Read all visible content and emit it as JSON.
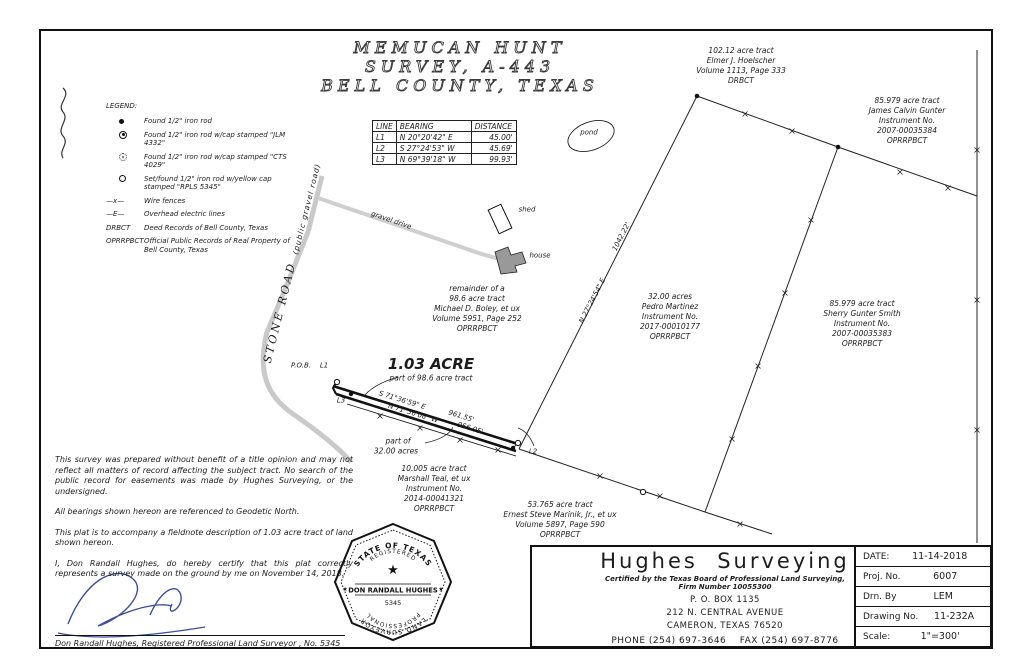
{
  "colors": {
    "ink": "#1c1c1c",
    "road_gray": "#c9c9c9",
    "house_fill": "#999999",
    "signature_blue": "#3c4f9e"
  },
  "title": {
    "line1": "MEMUCAN HUNT",
    "line2": "SURVEY, A-443",
    "line3": "BELL COUNTY, TEXAS"
  },
  "legend": {
    "heading": "LEGEND:",
    "items": [
      {
        "symbol": "found-iron-rod-dot",
        "text": "Found 1/2\" iron rod"
      },
      {
        "symbol": "found-iron-rod-cap-jlm",
        "text": "Found 1/2\" iron rod w/cap stamped \"JLM 4332\""
      },
      {
        "symbol": "found-iron-rod-cap-cts",
        "text": "Found 1/2\" iron rod w/cap stamped \"CTS 4029\""
      },
      {
        "symbol": "set-iron-rod-yellow-cap",
        "text": "Set/found 1/2\" iron rod w/yellow cap stamped \"RPLS 5345\""
      },
      {
        "symbol": "—x—",
        "text": "Wire fences"
      },
      {
        "symbol": "—E—",
        "text": "Overhead electric lines"
      },
      {
        "symbol": "DRBCT",
        "text": "Deed Records of Bell County, Texas"
      },
      {
        "symbol": "OPRRPBCT",
        "text": "Official Public Records of Real Property of Bell County, Texas"
      }
    ]
  },
  "line_table": {
    "headers": [
      "LINE",
      "BEARING",
      "DISTANCE"
    ],
    "rows": [
      [
        "L1",
        "N 20°20'42\" E",
        "45.00'"
      ],
      [
        "L2",
        "S 27°24'53\" W",
        "45.69'"
      ],
      [
        "L3",
        "N 69°39'18\" W",
        "99.93'"
      ]
    ]
  },
  "tracts": {
    "hoelscher": {
      "lines": [
        "102.12 acre tract",
        "Elmer J. Hoelscher",
        "Volume 1113, Page 333",
        "DRBCT"
      ]
    },
    "gunter_james": {
      "lines": [
        "85.979 acre tract",
        "James Calvin Gunter",
        "Instrument No.",
        "2007-00035384",
        "OPRRPBCT"
      ]
    },
    "boley": {
      "lines": [
        "remainder of a",
        "98.6 acre tract",
        "Michael D. Boley, et ux",
        "Volume 5951, Page 252",
        "OPRRPBCT"
      ]
    },
    "martinez": {
      "lines": [
        "32.00 acres",
        "Pedro Martinez",
        "Instrument No.",
        "2017-00010177",
        "OPRRPBCT"
      ]
    },
    "gunter_sherry": {
      "lines": [
        "85.979 acre tract",
        "Sherry Gunter Smith",
        "Instrument No.",
        "2007-00035383",
        "OPRRPBCT"
      ]
    },
    "teal": {
      "lines": [
        "10.005 acre tract",
        "Marshall Teal, et ux",
        "Instrument No.",
        "2014-00041321",
        "OPRRPBCT"
      ]
    },
    "marinik": {
      "lines": [
        "53.765 acre tract",
        "Ernest Steve Marinik, Jr., et ux",
        "Volume 5897, Page 590",
        "OPRRPBCT"
      ]
    }
  },
  "parcel": {
    "area": "1.03 ACRE",
    "part": "part of 98.6 acre tract",
    "part_of": "part of",
    "part_of_tract": "32.00 acres",
    "pob": "P.O.B.",
    "l1": "L1",
    "l2": "L2",
    "l3": "L3"
  },
  "bearings": {
    "ne_line": "N 27°24'54\" E",
    "ne_dist": "1042.22'",
    "strip_top": "S 71°36'59\" E",
    "strip_top_dist": "961.55'",
    "strip_bottom": "N 71°36'08\" W",
    "strip_bottom_dist": "956.05'"
  },
  "features": {
    "pond": "pond",
    "shed": "shed",
    "house": "house",
    "drive": "gravel drive",
    "road_name": "STONE ROAD",
    "road_sub": "(public gravel road)"
  },
  "notes": [
    "This survey was prepared without benefit of a title opinion and may not reflect all matters of record affecting the subject tract.  No search of the public record for easements was made by Hughes Surveying, or the undersigned.",
    "All bearings shown hereon are referenced to Geodetic North.",
    "This plat is to accompany a fieldnote description of 1.03 acre tract of land shown hereon.",
    "I, Don Randall Hughes, do hereby certify that this plat correctly represents a survey made on the ground by me on November 14, 2018."
  ],
  "surveyor_line": "Don Randall Hughes, Registered Professional Land Surveyor , No. 5345",
  "seal": {
    "state": "STATE OF TEXAS",
    "registered": "REGISTERED",
    "name": "DON RANDALL HUGHES",
    "number": "5345",
    "professional": "PROFESSIONAL",
    "surveyor": "LAND SURVEYOR"
  },
  "firm": {
    "name": "Hughes  Surveying",
    "certified": "Certified by the Texas Board of Professional Land Surveying, Firm Number 10055300",
    "addr1": "P. O. BOX 1135",
    "addr2": "212 N. CENTRAL AVENUE",
    "addr3": "CAMERON, TEXAS 76520",
    "phone": "PHONE (254) 697-3646    FAX (254) 697-8776"
  },
  "title_block": {
    "rows": [
      {
        "label": "DATE:",
        "value": "11-14-2018"
      },
      {
        "label": "Proj. No.",
        "value": "6007"
      },
      {
        "label": "Drn. By",
        "value": "LEM"
      },
      {
        "label": "Drawing No.",
        "value": "11-232A"
      },
      {
        "label": "Scale:",
        "value": "1\"=300'"
      }
    ]
  }
}
